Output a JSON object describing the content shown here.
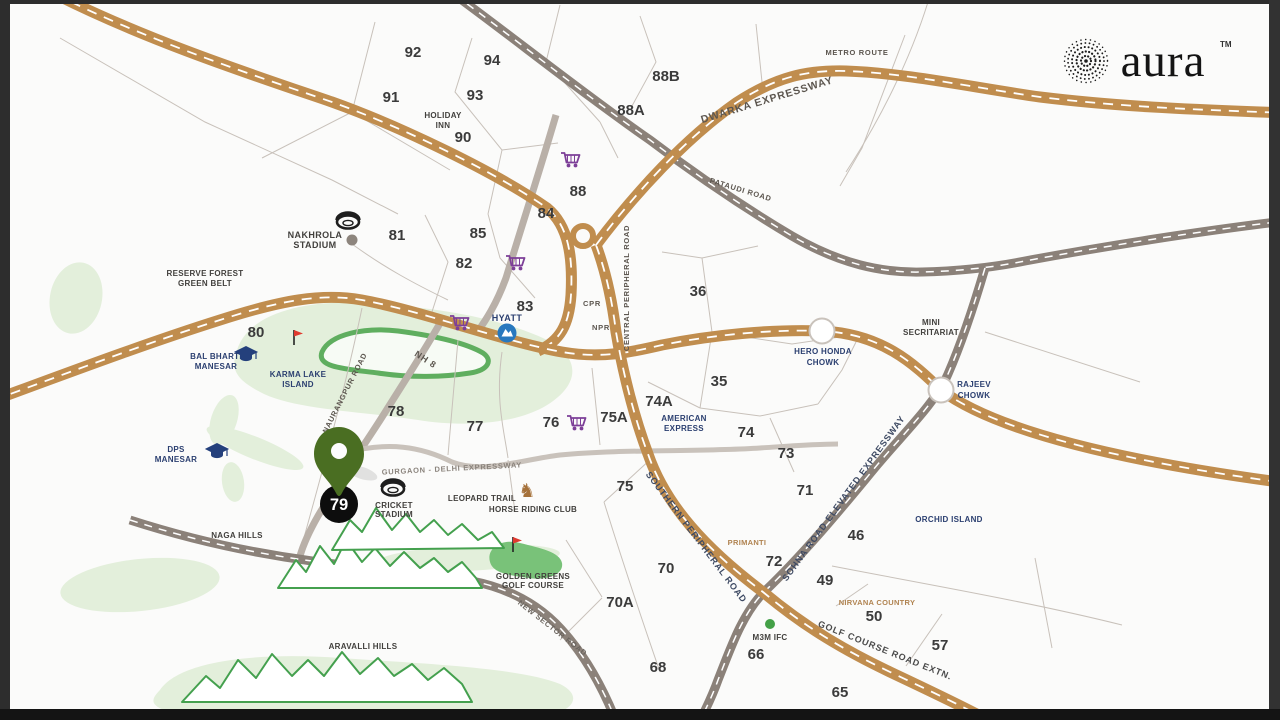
{
  "page": {
    "background": "#fbfbfa",
    "frame_color": "#2d2d2d",
    "bottom_bar_color": "#141414"
  },
  "logo": {
    "brand": "aura",
    "tm": "TM"
  },
  "colors": {
    "expressway_brown": "#c08d4e",
    "road_gray": "#8b8179",
    "pin_green": "#4a6e22",
    "landmark_navy": "#2b3f70",
    "estate_tan": "#b08350",
    "retail_purple": "#7d3f98",
    "hill_green": "#44a04e"
  },
  "pin": {
    "sector": "79"
  },
  "sectors": {
    "s92": "92",
    "s94": "94",
    "s91": "91",
    "s93": "93",
    "s90": "90",
    "s88b": "88B",
    "s88a": "88A",
    "s88": "88",
    "s84": "84",
    "s81": "81",
    "s85": "85",
    "s82": "82",
    "s83": "83",
    "s36": "36",
    "s80": "80",
    "s35": "35",
    "s74a": "74A",
    "s78": "78",
    "s77": "77",
    "s76": "76",
    "s75a": "75A",
    "s74": "74",
    "s73": "73",
    "s71": "71",
    "s75": "75",
    "s72": "72",
    "s46": "46",
    "s70": "70",
    "s49": "49",
    "s50": "50",
    "s57": "57",
    "s70a": "70A",
    "s68": "68",
    "s66": "66",
    "s65": "65"
  },
  "places": {
    "holiday": {
      "l1": "HOLIDAY",
      "l2": "INN"
    },
    "nakhrola": {
      "l1": "NAKHROLA",
      "l2": "STADIUM"
    },
    "reserve": {
      "l1": "RESERVE FOREST",
      "l2": "GREEN BELT"
    },
    "balbharti": {
      "l1": "BAL BHARTI",
      "l2": "MANESAR"
    },
    "karma": {
      "l1": "KARMA LAKE",
      "l2": "ISLAND"
    },
    "dps": {
      "l1": "DPS",
      "l2": "MANESAR"
    },
    "hyatt": "HYATT",
    "amex": {
      "l1": "AMERICAN",
      "l2": "EXPRESS"
    },
    "herohonda": {
      "l1": "HERO HONDA",
      "l2": "CHOWK"
    },
    "rajeev": {
      "l1": "RAJEEV",
      "l2": "CHOWK"
    },
    "mini": {
      "l1": "MINI",
      "l2": "SECRITARIAT"
    },
    "orchid": "ORCHID ISLAND",
    "cricket": {
      "l1": "CRICKET",
      "l2": "STADIUM"
    },
    "leopard": "LEOPARD TRAIL",
    "horse": "HORSE RIDING CLUB",
    "golden": {
      "l1": "GOLDEN GREENS",
      "l2": "GOLF COURSE"
    },
    "naga": "NAGA HILLS",
    "aravalli": "ARAVALLI HILLS",
    "m3m": "M3M IFC",
    "nirvana": "NIRVANA COUNTRY",
    "primanti": "PRIMANTI",
    "cpr": "CPR",
    "npr": "NPR"
  },
  "roads": {
    "dwarka": "DWARKA EXPRESSWAY",
    "metro": "METRO ROUTE",
    "pataudi": "PATAUDI ROAD",
    "nh8": "NH 8",
    "naurangpur": "NAURANGPUR ROAD",
    "central": "CENTRAL PERIPHERAL ROAD",
    "gdexp": "GURGAON - DELHI EXPRESSWAY",
    "spr": "SOUTHERN PERIPHERAL ROAD",
    "sohna": "SOHNA ROAD ELEVATED EXPRESSWAY",
    "golf": "GOLF COURSE ROAD EXTN.",
    "newsector": "NEW SECTOR ROAD"
  },
  "icons": {
    "horse_glyph": "♞"
  }
}
